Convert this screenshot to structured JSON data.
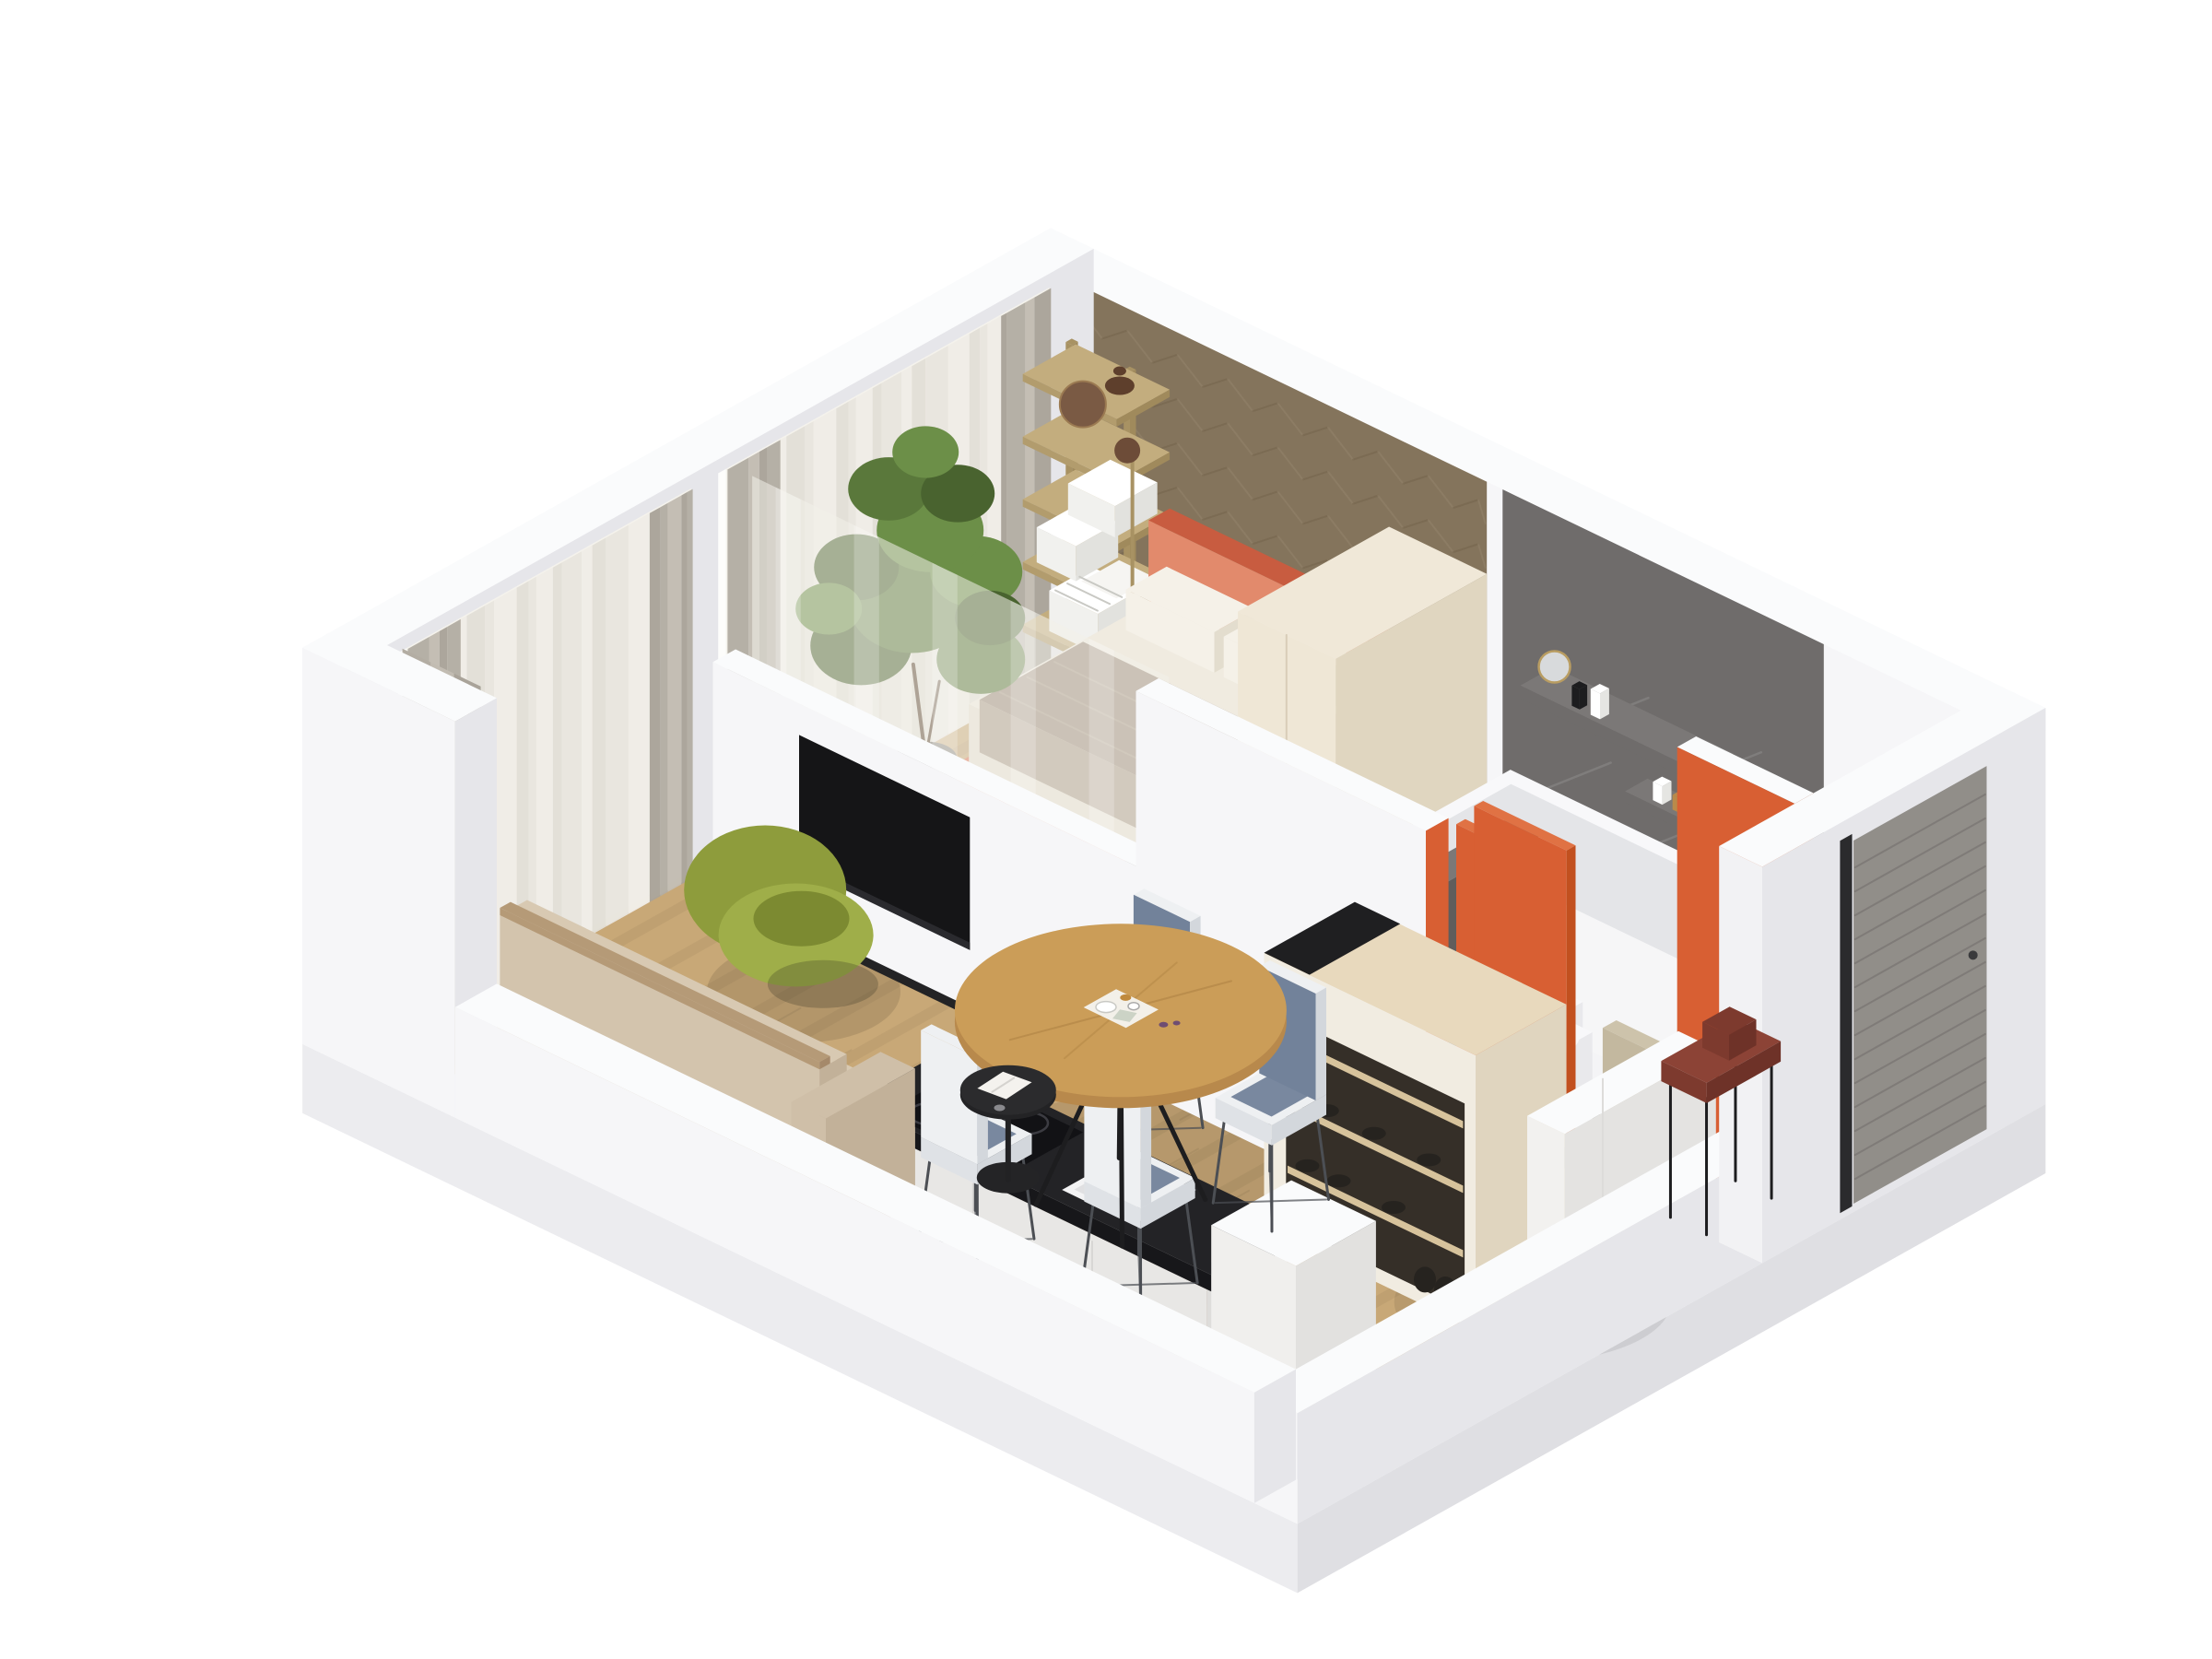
{
  "page": {
    "background": "#ffffff",
    "kind": "isometric-3d-apartment-floor-plan-render"
  },
  "scene": {
    "view": "axonometric-cutaway-from-above",
    "rooms": [
      {
        "name": "living-dining-room",
        "furniture": [
          "beige-sofa",
          "green-lounge-chair",
          "black-side-table",
          "round-wood-dining-table",
          "dining-chairs-x4",
          "wall-mounted-tv",
          "tv-half-wall",
          "gray-and-sheer-curtains"
        ]
      },
      {
        "name": "bedroom",
        "furniture": [
          "orange-double-bed",
          "white-pillows",
          "taupe-throw",
          "cream-area-rug",
          "herringbone-wood-accent-wall",
          "ladder-bookshelf-with-books",
          "floor-lamp",
          "potted-plant",
          "cream-armchair",
          "black-marble-coffee-table",
          "sheer-room-divider",
          "cream-wardrobe"
        ]
      },
      {
        "name": "bathroom",
        "furniture": [
          "white-bathtub",
          "wall-hung-toilet",
          "washbasin",
          "gray-stone-feature-wall",
          "gray-stone-floor",
          "stone-toiletry-ledges",
          "orange-door-panels"
        ]
      },
      {
        "name": "kitchen",
        "furniture": [
          "black-countertop",
          "induction-hob",
          "inset-sink-with-faucet",
          "white-base-cabinets",
          "white-tall-cabinet"
        ]
      },
      {
        "name": "hallway-entry",
        "furniture": [
          "entry-closet-with-shoe-shelves",
          "beige-chair",
          "white-sideboard-bench",
          "salmon-rug",
          "maroon-console-table",
          "gray-slatted-entry-door",
          "orange-accent-wall"
        ]
      }
    ]
  },
  "colors": {
    "bg": "#ffffff",
    "wallTop": "#fafbfc",
    "wallFaceL": "#f6f6f8",
    "wallFaceR": "#e6e6ea",
    "wallOuter": "#ececef",
    "wallOuterR": "#dfdfe3",
    "floorWood": "#c8a877",
    "plankShade": "rgba(0,0,0,0.045)",
    "plankSeam": "rgba(0,0,0,0.06)",
    "stoneWall": "#6f6c6b",
    "stoneWallDark": "#605d5c",
    "stoneTop": "#7b7877",
    "stoneFloor": "#7b7877",
    "stoneVein": "rgba(255,255,255,0.13)",
    "herring": "#84745c",
    "herringDark": "#75654d",
    "herringLight": "#93836b",
    "orange": "#d85f33",
    "orangeLight": "#e07244",
    "orangeDark": "#c2501f",
    "salmon": "#eb9270",
    "bedOrange": "#dd7356",
    "bedOrangeLight": "#e28a6c",
    "bedOrangeDark": "#c85c40",
    "mattressTop": "#f0ebe0",
    "mattressL": "#e6e0d2",
    "mattressR": "#d9d2c2",
    "pillow": "#f5f1e8",
    "pillowShade": "#e3ddce",
    "blanket": "#9b8b7a",
    "blanketLight": "#ac9c8b",
    "blanketDark": "#8a7a69",
    "rugCream": "#ddd5c5",
    "rugEdge": "#2e2c2a",
    "green1": "#8e9c3c",
    "green2": "#9fae49",
    "green3": "#7c8a31",
    "sofa": "#cfbfa8",
    "sofaTop": "#d8c9b2",
    "sofaDark": "#c2b199",
    "sofaBack": "#d3c4ad",
    "sofaWood": "#b59a77",
    "tableWood": "#cb9d58",
    "tableWoodDark": "#b8894c",
    "chairShell": "#eef0f2",
    "chairShellL": "#dfe2e6",
    "chairShellD": "#d3d7dc",
    "chairCushion": "#72829a",
    "black": "#1d1d1f",
    "tv": "#151517",
    "counterTop": "#232326",
    "counterL": "#17171a",
    "counterR": "#0e0e10",
    "hob": "#121215",
    "ring": "#3c3c42",
    "islandTop": "#e8d9bd",
    "islandL": "#f1ece1",
    "islandR": "#e0d5bf",
    "recess": "#352f28",
    "shelfWood": "#d7c39c",
    "creamTop": "#f0e8d8",
    "creamL": "#efe7d6",
    "creamR": "#e0d6c0",
    "beige": "#cdc3ab",
    "beigeDark": "#c3b89f",
    "white": "#ffffff",
    "fixWhite": "#f4f4f6",
    "fixTop": "#f8f8fa",
    "fixInner": "#e9e9ec",
    "tubInner": "#e4e5e8",
    "tubFloor": "#f6f6f7",
    "doorGray": "#918e89",
    "doorLine": "#777470",
    "reveal": "#2b2b2d",
    "maroon": "#8c4336",
    "maroonL": "#7d3a2e",
    "maroonD": "#6e3228",
    "brass": "#a89263",
    "shelfTop": "#c3ad7e",
    "shelfL": "#b29c6d",
    "shelfR": "#a08a5c",
    "curtainG1": "#b3ada3",
    "curtainG2": "#c2bcb2",
    "curtainG3": "#a9a399",
    "curtainL1": "#e8e5de",
    "curtainL2": "#efece6",
    "curtainL3": "#e2dfd7",
    "sheer": "#f3f1ea",
    "plantG1": "#49632f",
    "plantG2": "#5a783b",
    "plantG3": "#6c8f48",
    "pot": "#66625d",
    "potTop": "#716d67",
    "potDark": "#3d3a36",
    "trunk": "#5b4631",
    "mirrorWood": "#7a5a44",
    "vase": "#5e3f2c",
    "chrome": "#b9bfc6",
    "legGray": "#4c4f54",
    "shadow": "#000000"
  }
}
